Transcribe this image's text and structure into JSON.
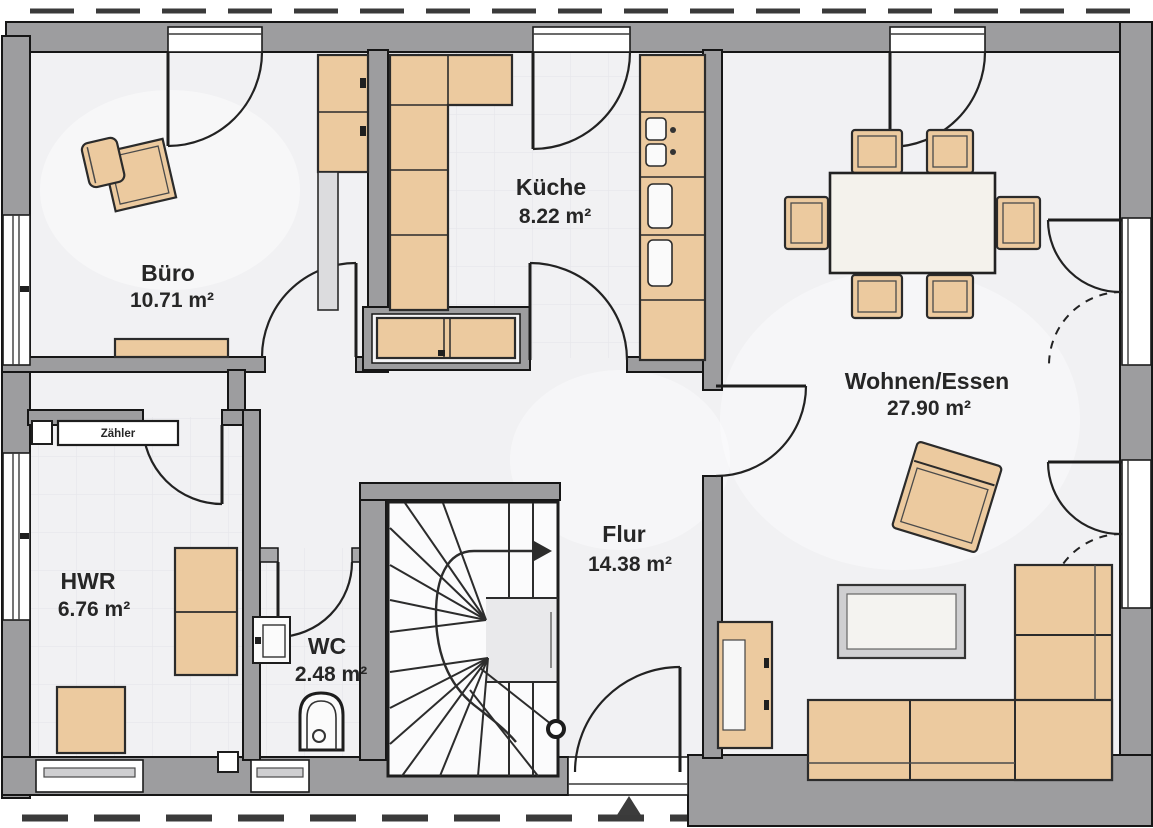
{
  "plan": {
    "rooms": [
      {
        "id": "buero",
        "name": "Büro",
        "area": "10.71 m²"
      },
      {
        "id": "kueche",
        "name": "Küche",
        "area": "8.22 m²"
      },
      {
        "id": "wohnen-essen",
        "name": "Wohnen/Essen",
        "area": "27.90 m²"
      },
      {
        "id": "hwr",
        "name": "HWR",
        "area": "6.76 m²"
      },
      {
        "id": "wc",
        "name": "WC",
        "area": "2.48 m²"
      },
      {
        "id": "flur",
        "name": "Flur",
        "area": "14.38 m²"
      }
    ],
    "meter_box_label": "Zähler",
    "colors": {
      "wall": "#9d9d9f",
      "outline": "#1a1a1a",
      "floor": "#f1f1f3",
      "furniture": "#ecca9f",
      "table_top": "#f4f2ec",
      "landing": "#e9e9eb"
    },
    "icons": [
      "door-swing-arc-icon",
      "double-terrace-door-dashed-icon",
      "window-icon",
      "winder-stairs-icon",
      "toilet-icon",
      "washbasin-icon",
      "kitchen-sink-icon",
      "entrance-arrow-icon"
    ]
  }
}
